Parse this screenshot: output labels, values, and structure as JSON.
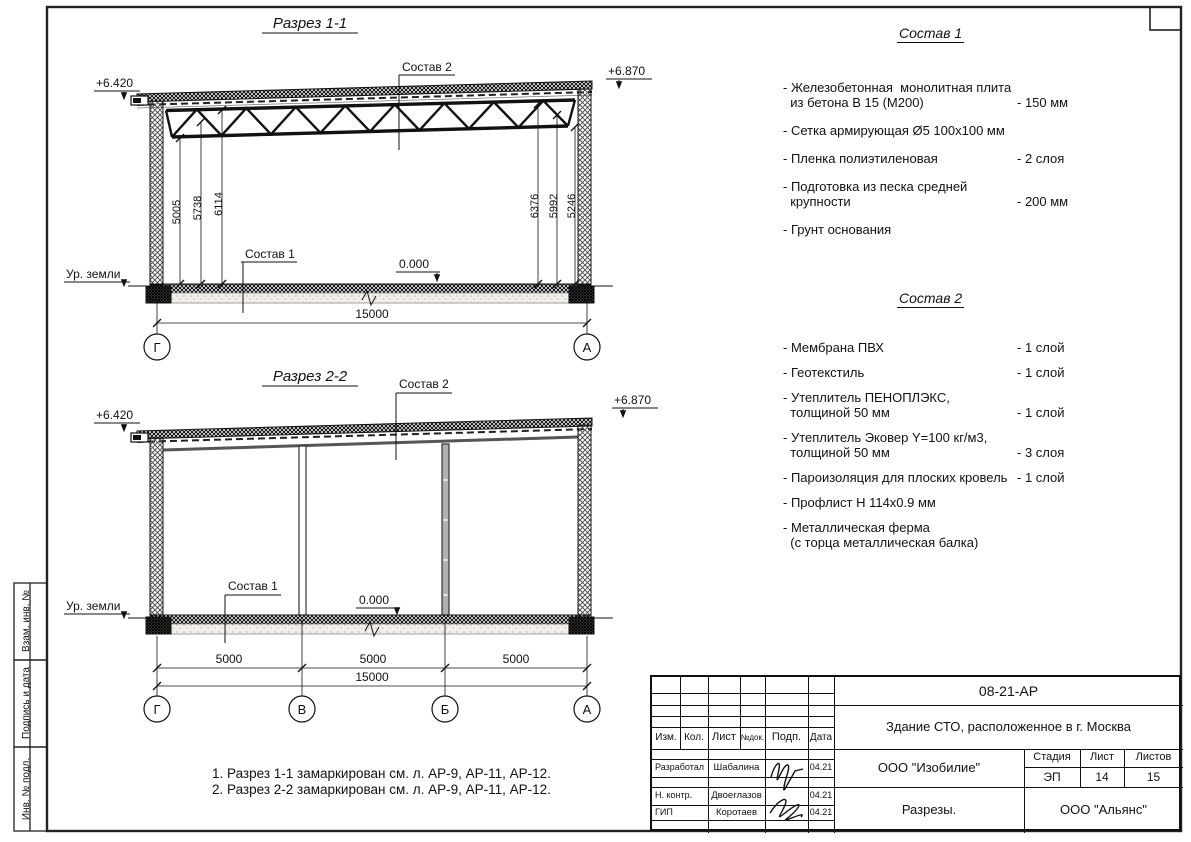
{
  "labels": {
    "ground": "Ур. земли",
    "zero": "0.000",
    "leader_floor": "Состав 1",
    "leader_roof": "Состав 2"
  },
  "section1": {
    "title": "Разрез 1-1",
    "elev_left": "+6.420",
    "elev_right": "+6.870",
    "dims_left": [
      "5005",
      "5738",
      "6114"
    ],
    "dims_right": [
      "6376",
      "5992",
      "5246"
    ],
    "dim_total": "15000",
    "axes": [
      "Г",
      "А"
    ]
  },
  "section2": {
    "title": "Разрез 2-2",
    "elev_left": "+6.420",
    "elev_right": "+6.870",
    "dims": [
      "5000",
      "5000",
      "5000"
    ],
    "dim_total": "15000",
    "axes": [
      "Г",
      "В",
      "Б",
      "А"
    ]
  },
  "sostav1": {
    "title": "Состав 1",
    "items": [
      {
        "name": "- Железобетонная  монолитная плита\n  из бетона В 15 (М200)",
        "value": "- 150 мм"
      },
      {
        "name": "- Сетка армирующая Ø5 100х100 мм",
        "value": ""
      },
      {
        "name": "- Пленка полиэтиленовая",
        "value": "-  2 слоя"
      },
      {
        "name": "- Подготовка из песка средней\n  крупности",
        "value": "- 200 мм"
      },
      {
        "name": "- Грунт основания",
        "value": ""
      }
    ]
  },
  "sostav2": {
    "title": "Состав 2",
    "items": [
      {
        "name": "- Мембрана ПВХ",
        "value": "- 1 слой"
      },
      {
        "name": "- Геотекстиль",
        "value": "- 1 слой"
      },
      {
        "name": "- Утеплитель ПЕНОПЛЭКС,\n  толщиной 50 мм",
        "value": "- 1 слой"
      },
      {
        "name": "- Утеплитель Эковер Y=100 кг/м3,\n  толщиной 50 мм",
        "value": "- 3 слоя"
      },
      {
        "name": "- Пароизоляция для плоских кровель",
        "value": "- 1 слой"
      },
      {
        "name": "- Профлист Н 114х0.9 мм",
        "value": ""
      },
      {
        "name": "- Металлическая ферма\n  (с торца металлическая балка)",
        "value": ""
      }
    ]
  },
  "notes": [
    "1. Разрез 1-1 замаркирован см. л. АР-9, АР-11, АР-12.",
    "2. Разрез 2-2 замаркирован см. л. АР-9, АР-11, АР-12."
  ],
  "sidebar": {
    "labels": [
      "Взам. инв. №",
      "Подпись и дата",
      "Инв. № подл."
    ]
  },
  "titleblock": {
    "doc_number": "08-21-АР",
    "project": "Здание СТО, расположенное в г. Москва",
    "company": "ООО \"Изобилие\"",
    "sheet_title": "Разрезы.",
    "contractor": "ООО \"Альянс\"",
    "stage_label": "Стадия",
    "sheet_label": "Лист",
    "sheets_label": "Листов",
    "stage": "ЭП",
    "sheet_no": "14",
    "sheets_total": "15",
    "header": {
      "izm": "Изм.",
      "kol": "Кол.",
      "list": "Лист",
      "ndok": "№док.",
      "podp": "Подп.",
      "data": "Дата"
    },
    "rows": [
      {
        "role": "Разработал",
        "name": "Шабалина",
        "date": "04.21"
      },
      {
        "role": "Н. контр.",
        "name": "Двоеглазов",
        "date": "04.21"
      },
      {
        "role": "ГИП",
        "name": "Коротаев",
        "date": "04.21"
      }
    ]
  }
}
